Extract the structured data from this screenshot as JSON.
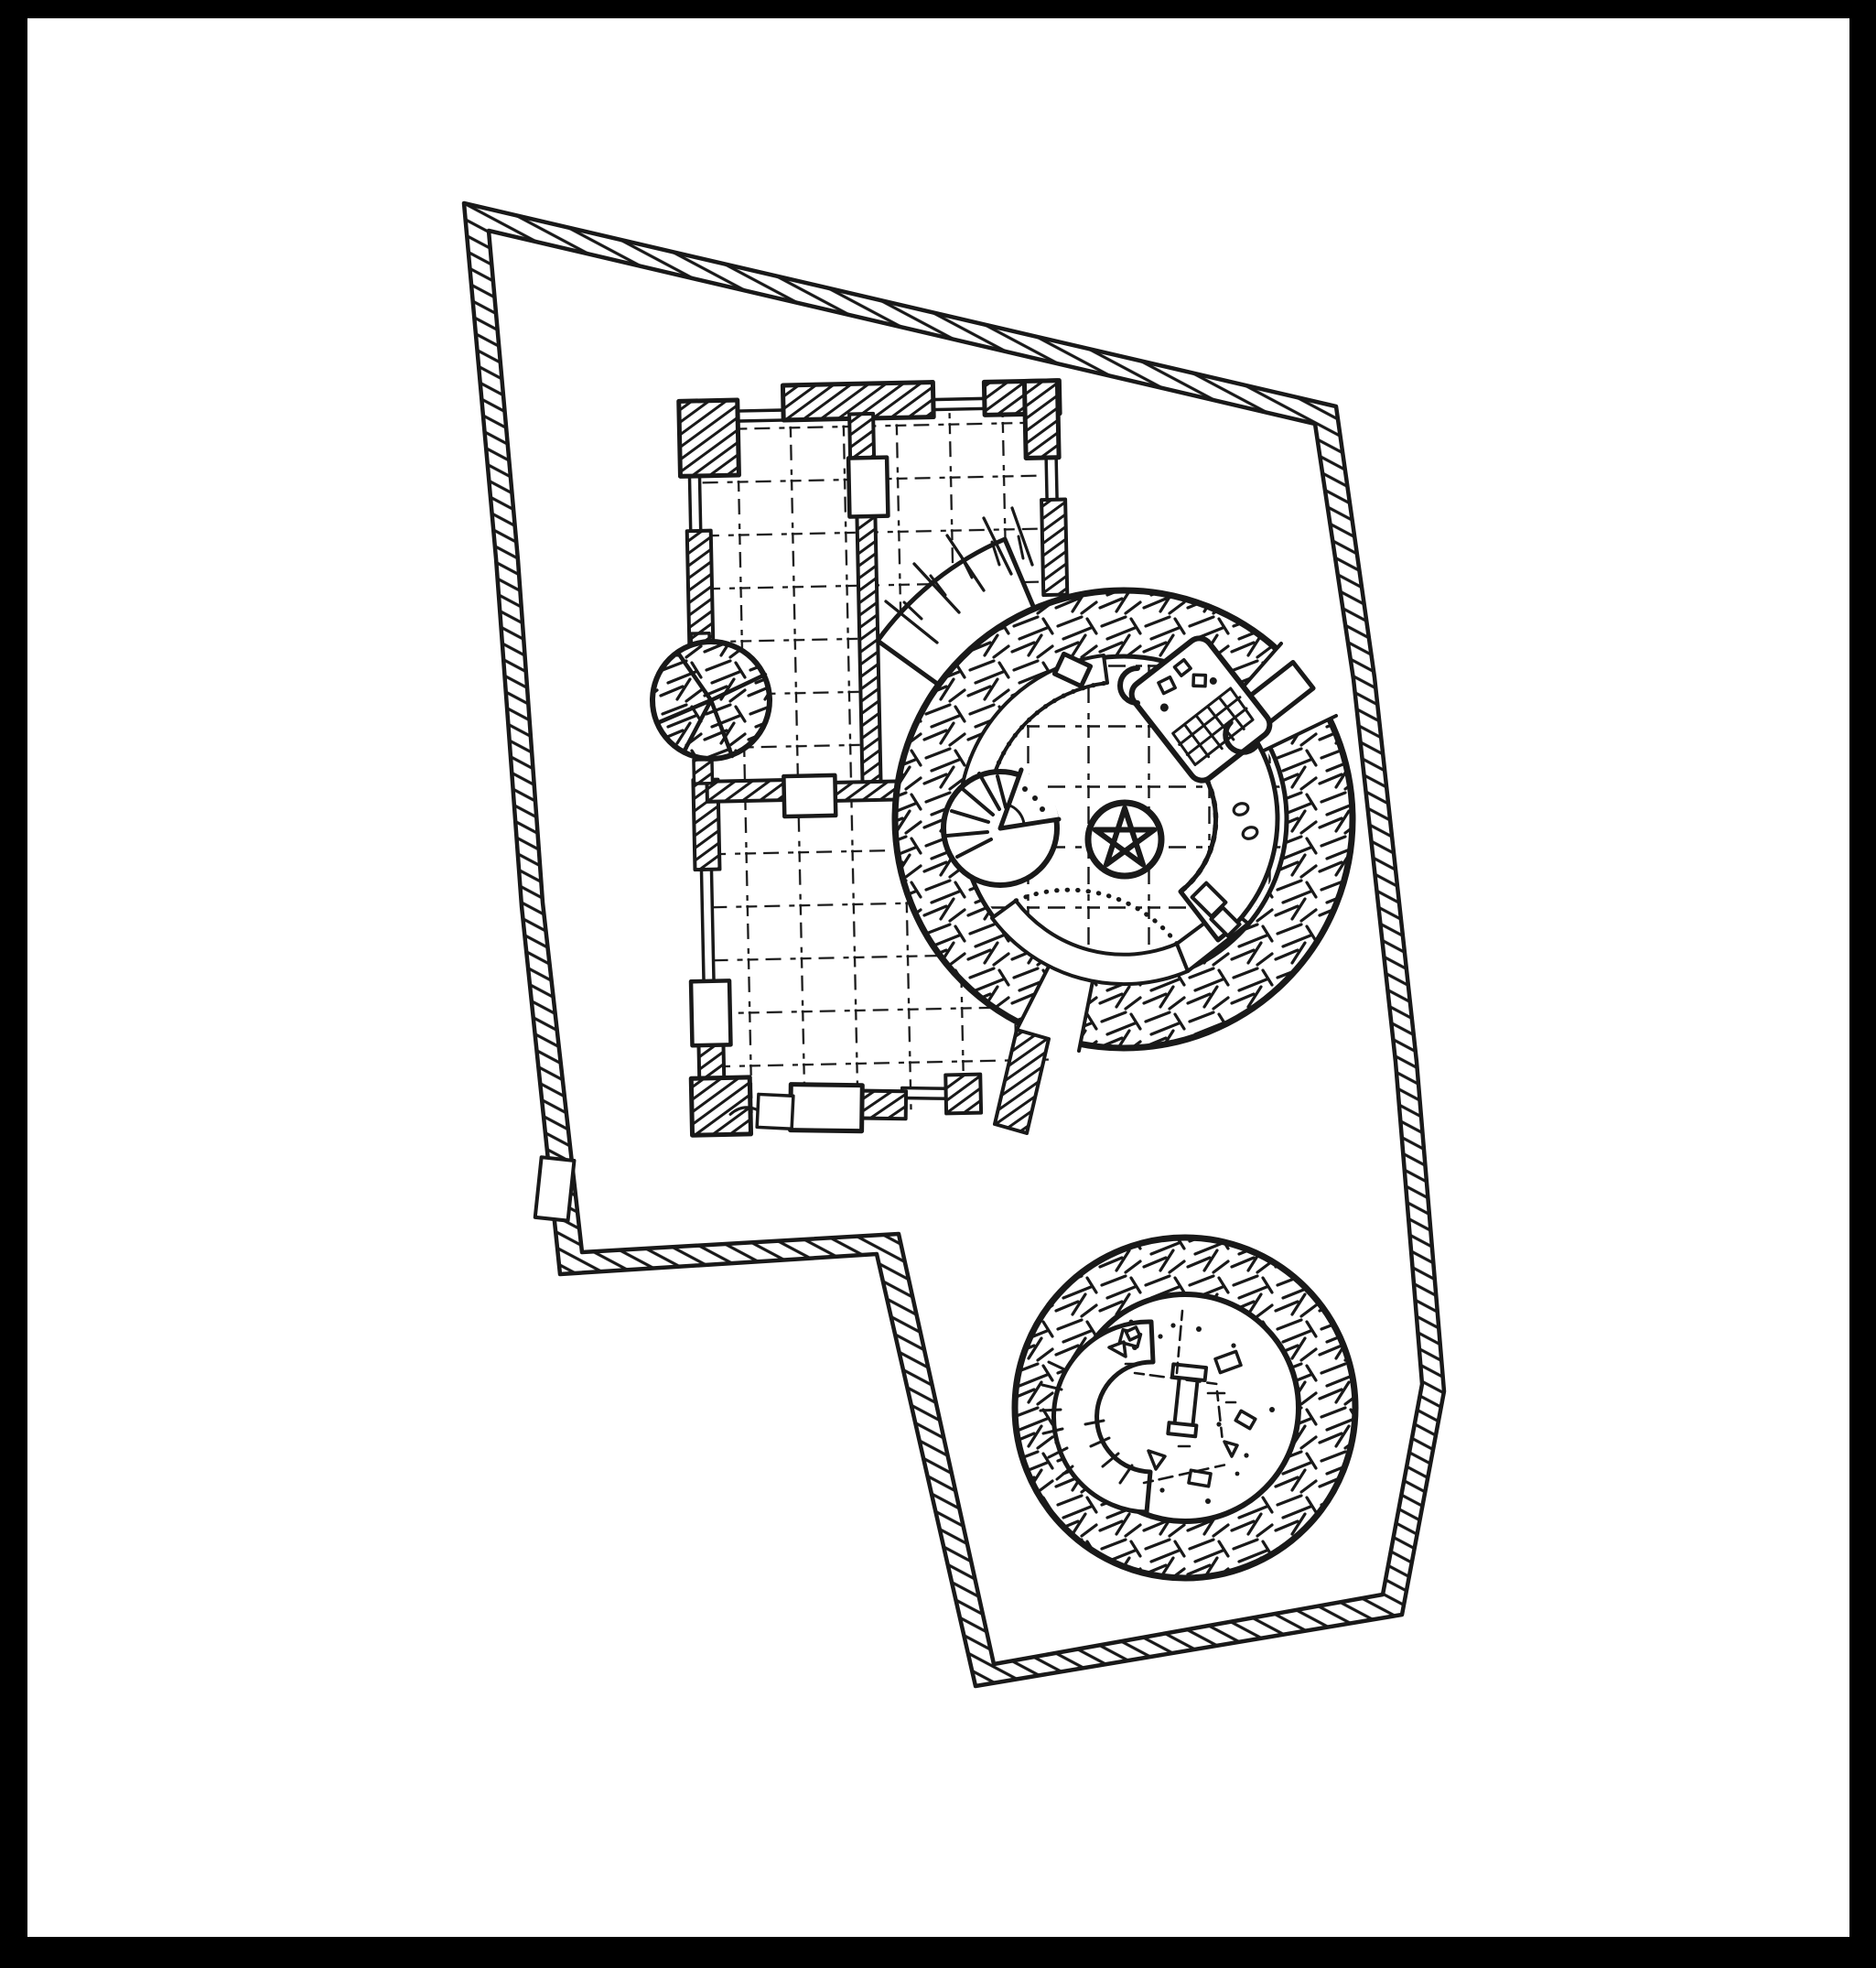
{
  "page": {
    "frame_color": "#000000",
    "paper_color": "#ffffff",
    "ink_color": "#191919"
  },
  "map": {
    "type": "hand-drawn ink floor plan of a walled keep",
    "orientation": "irregular quadrilateral enclosure tilted to the right",
    "features": [
      {
        "name": "curtain-wall",
        "desc": "irregular hatched double-line enclosure wall with notched south-west corner"
      },
      {
        "name": "west-gate",
        "desc": "small white gate opening in the lower left stretch of the curtain wall"
      },
      {
        "name": "great-hall",
        "desc": "rectangular building with three grid-floored rooms, hatched corner pillars and door openings"
      },
      {
        "name": "corner-turret",
        "desc": "small round roofed turret on the west wall of the hall, radial sector hatching"
      },
      {
        "name": "fan-staircase",
        "desc": "outdoor fan-shaped stair wedge between the hall and the great tower"
      },
      {
        "name": "great-tower",
        "desc": "large round tower with basket-weave ring wall, gridded floor"
      },
      {
        "name": "tower-spiral-stair",
        "desc": "spiral staircase disc with wedge opening inside great tower"
      },
      {
        "name": "pentagram-seal",
        "desc": "five-pointed star in a circle at the tower center"
      },
      {
        "name": "game-table",
        "desc": "rounded rectangular table with checkered board and scattered pieces"
      },
      {
        "name": "chairs",
        "desc": "two C-shaped chairs beside the game table"
      },
      {
        "name": "curved-galleries",
        "desc": "two white curved gallery walks with dotted edges along the inner ring"
      },
      {
        "name": "curved-bench",
        "desc": "scallop-edged curved bench on the east side with two crates and two ovals"
      },
      {
        "name": "east-door",
        "desc": "angled door opening through the ring wall on the east"
      },
      {
        "name": "south-passage",
        "desc": "gap and hatched stub wall linking tower ring to the hall's south wall"
      },
      {
        "name": "ruined-tower",
        "desc": "smaller round tower to the south, basket-weave ring"
      },
      {
        "name": "collapsed-stair",
        "desc": "white spiral wall fragment with radial tick marks inside ruined tower"
      },
      {
        "name": "rubble-field",
        "desc": "scattered debris, blocks, shards and dots covering ruined tower floor"
      }
    ],
    "counts": {
      "towers": 2,
      "hall_rooms": 3,
      "turrets": 1,
      "gates": 1,
      "spiral_stairs": 2,
      "chairs": 2
    }
  }
}
